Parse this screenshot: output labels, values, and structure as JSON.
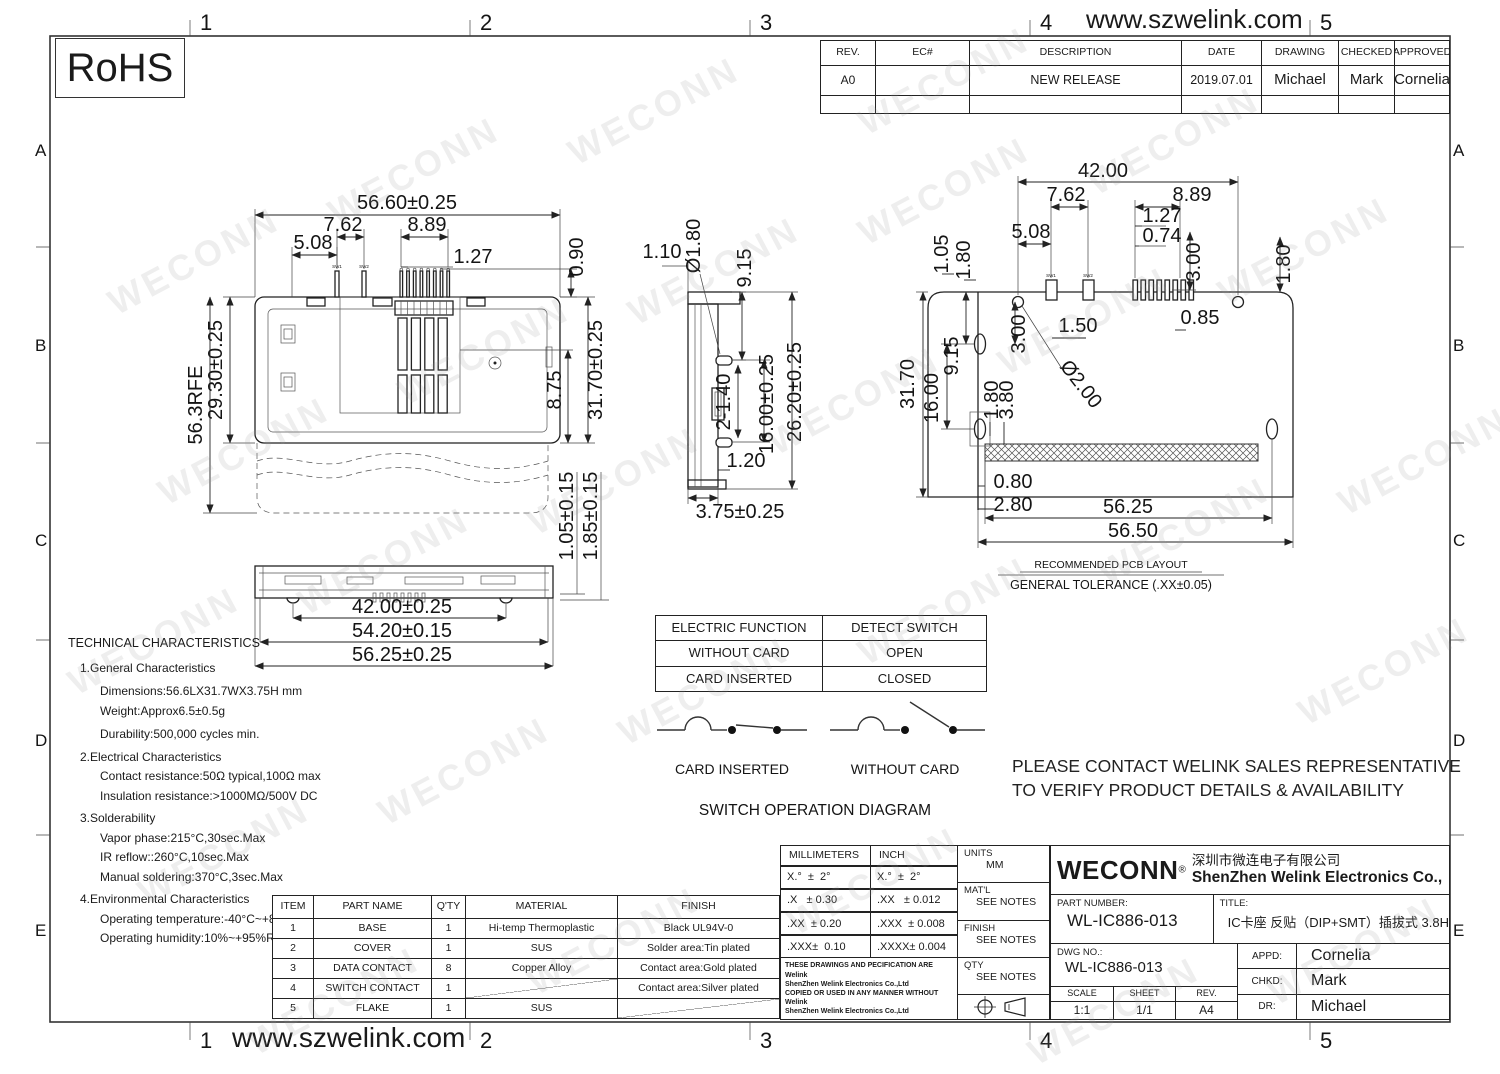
{
  "page": {
    "website": "www.szwelink.com",
    "rohs_label": "RoHS",
    "watermark": "WECONN",
    "grid_cols": [
      "1",
      "2",
      "3",
      "4",
      "5"
    ],
    "grid_rows": [
      "A",
      "B",
      "C",
      "D",
      "E"
    ]
  },
  "revision_table": {
    "headers": [
      "REV.",
      "EC#",
      "DESCRIPTION",
      "DATE",
      "DRAWING",
      "CHECKED",
      "APPROVED"
    ],
    "rows": [
      [
        "A0",
        "",
        "NEW RELEASE",
        "2019.07.01",
        "Michael",
        "Mark",
        "Cornelia"
      ],
      [
        "",
        "",
        "",
        "",
        "",
        "",
        ""
      ]
    ]
  },
  "views": {
    "top": {
      "sw1": "SW1",
      "sw2": "SW2",
      "w": "56.60±0.25",
      "d762": "7.62",
      "d889": "8.89",
      "d508": "5.08",
      "d127": "1.27",
      "d090": "0.90",
      "d875": "8.75",
      "h": "31.70±0.25",
      "d2930": "29.30±0.25",
      "dref": "56.3RFE"
    },
    "front": {
      "d42": "42.00±0.25",
      "d5420": "54.20±0.15",
      "d5625": "56.25±0.25",
      "d105": "1.05±0.15",
      "d185": "1.85±0.15"
    },
    "side": {
      "d110": "1.10",
      "dd180": "Ø1.80",
      "d915": "9.15",
      "d2140": "2-1.40",
      "d1600": "16.00±0.25",
      "d2620": "26.20±0.25",
      "d120": "1.20",
      "d375": "3.75±0.25"
    },
    "pcb": {
      "sw1": "SW1",
      "sw2": "SW2",
      "d42": "42.00",
      "d762": "7.62",
      "d889": "8.89",
      "d508": "5.08",
      "d127": "1.27",
      "d074": "0.74",
      "d300t": "3.00",
      "d180r": "1.80",
      "d105": "1.05",
      "d180l": "1.80",
      "d150": "1.50",
      "dd200": "Ø2.00",
      "d300l": "3.00",
      "d085": "0.85",
      "d3170": "31.70",
      "d1600": "16.00",
      "d915": "9.15",
      "d180i": "1.80",
      "d380": "3.80",
      "d080": "0.80",
      "d280": "2.80",
      "d5625": "56.25",
      "d5650": "56.50",
      "caption1": "RECOMMENDED PCB LAYOUT",
      "caption2": "GENERAL TOLERANCE (.XX±0.05)"
    }
  },
  "technical": {
    "title": "TECHNICAL CHARACTERISTICS",
    "lines": [
      {
        "text": "1.General Characteristics"
      },
      {
        "text": "Dimensions:56.6LX31.7WX3.75H mm"
      },
      {
        "text": "Weight:Approx6.5±0.5g"
      },
      {
        "text": "Durability:500,000 cycles min."
      },
      {
        "text": "2.Electrical Characteristics"
      },
      {
        "text": "Contact resistance:50Ω typical,100Ω max"
      },
      {
        "text": "Insulation resistance:>1000MΩ/500V DC"
      },
      {
        "text": "3.Solderability"
      },
      {
        "text": "Vapor phase:215°C,30sec.Max"
      },
      {
        "text": "IR reflow::260°C,10sec.Max"
      },
      {
        "text": "Manual soldering:370°C,3sec.Max"
      },
      {
        "text": "4.Environmental Characteristics"
      },
      {
        "text": "Operating temperature:-40°C~+85°C"
      },
      {
        "text": "Operating humidity:10%~+95%RH"
      }
    ]
  },
  "electric_table": {
    "rows": [
      [
        "ELECTRIC FUNCTION",
        "DETECT SWITCH"
      ],
      [
        "WITHOUT CARD",
        "OPEN"
      ],
      [
        "CARD INSERTED",
        "CLOSED"
      ]
    ]
  },
  "switch_diagram": {
    "closed_label": "CARD INSERTED",
    "open_label": "WITHOUT CARD",
    "title": "SWITCH OPERATION DIAGRAM"
  },
  "notice": {
    "line1": "PLEASE CONTACT WELINK SALES REPRESENTATIVE",
    "line2": "TO VERIFY PRODUCT DETAILS & AVAILABILITY"
  },
  "parts_table": {
    "headers": [
      "ITEM",
      "PART NAME",
      "Q'TY",
      "MATERIAL",
      "FINISH"
    ],
    "rows": [
      [
        "1",
        "BASE",
        "1",
        "Hi-temp Thermoplastic",
        "Black UL94V-0"
      ],
      [
        "2",
        "COVER",
        "1",
        "SUS",
        "Solder area:Tin plated"
      ],
      [
        "3",
        "DATA CONTACT",
        "8",
        "Copper Alloy",
        "Contact area:Gold plated"
      ],
      [
        "4",
        "SWITCH CONTACT",
        "1",
        "",
        "Contact area:Silver plated"
      ],
      [
        "5",
        "FLAKE",
        "1",
        "SUS",
        ""
      ]
    ]
  },
  "tolerance_table": {
    "mm_header": "MILLIMETERS",
    "inch_header": "INCH",
    "mm_rows": [
      "X.°  ±  2°",
      ".X   ± 0.30",
      ".XX  ± 0.20",
      ".XXX±  0.10"
    ],
    "inch_rows": [
      "X.°  ±  2°",
      ".XX   ± 0.012",
      ".XXX  ± 0.008",
      ".XXXX± 0.004"
    ],
    "disclaimer_lines": [
      "THESE DRAWINGS AND PECIFICATION ARE Welink",
      "ShenZhen Welink Electronics Co.,Ltd",
      "COPIED OR USED IN ANY MANNER WITHOUT Welink",
      "ShenZhen Welink Electronics Co.,Ltd"
    ],
    "units_label": "UNITS",
    "units_value": "MM",
    "matl_label": "MAT'L",
    "matl_value": "SEE NOTES",
    "finish_label": "FINISH",
    "finish_value": "SEE NOTES",
    "qty_label": "QTY",
    "qty_value": "SEE NOTES"
  },
  "title_block": {
    "logo": "WECONN",
    "registered": "®",
    "company_cn": "深圳市微连电子有限公司",
    "company_en": "ShenZhen Welink Electronics Co.,Ltd",
    "part_number_label": "PART NUMBER:",
    "part_number": "WL-IC886-013",
    "title_label": "TITLE:",
    "product_title": "IC卡座 反贴（DIP+SMT）插拔式 3.8H",
    "dwg_label": "DWG NO.:",
    "dwg_no": "WL-IC886-013",
    "scale_label": "SCALE",
    "scale": "1:1",
    "sheet_label": "SHEET",
    "sheet": "1/1",
    "rev_label": "REV.",
    "rev": "A4",
    "appd_label": "APPD:",
    "appd": "Cornelia",
    "chkd_label": "CHKD:",
    "chkd": "Mark",
    "dr_label": "DR:",
    "dr": "Michael"
  }
}
